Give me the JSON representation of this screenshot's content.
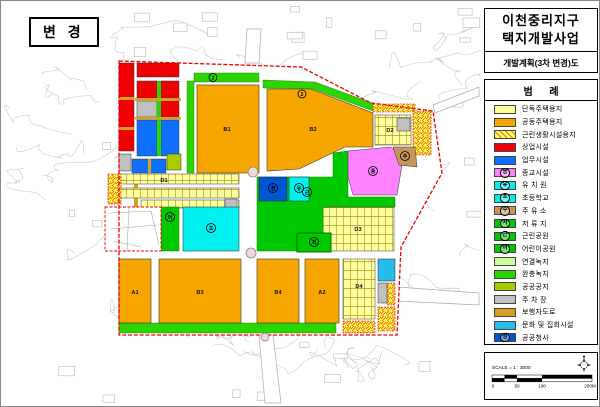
{
  "map": {
    "change_label": "변 경",
    "blocks": {
      "b1": "B1",
      "b2": "B2",
      "b3": "B3",
      "b4": "B4",
      "a1": "A1",
      "a2": "A2",
      "d1": "D1",
      "d2": "D2",
      "d3": "D3",
      "d4": "D4"
    },
    "marks": {
      "buffer1": "2",
      "buffer2": "2",
      "religious": "종",
      "gas": "주",
      "kindergarten": "유",
      "office": "청",
      "park": "근",
      "pond": "저",
      "children": "어",
      "school": "초"
    }
  },
  "panel": {
    "title_line1": "이천중리지구",
    "title_line2": "택지개발사업",
    "subtitle": "개발계획(3차 변경)도",
    "legend_title": "범      례",
    "scale_text": "SCALE = 1 : 3000",
    "scale_ticks": [
      "0",
      "50",
      "100",
      "200M"
    ]
  },
  "legend": {
    "items": [
      {
        "label": "단독주택용지",
        "color": "#FFFF99"
      },
      {
        "label": "공동주택용지",
        "color": "#F7A600"
      },
      {
        "label": "근린생활시설용지",
        "color": "#FFFF66",
        "hatch": true
      },
      {
        "label": "상업시설",
        "color": "#F00000"
      },
      {
        "label": "업무시설",
        "color": "#0F6FFF"
      },
      {
        "label": "종교시설",
        "color": "#FF82FF",
        "mark": "종"
      },
      {
        "label": "유 치 원",
        "color": "#00F0F0",
        "mark": "유"
      },
      {
        "label": "초등학교",
        "color": "#00F0F0",
        "mark": "초"
      },
      {
        "label": "주 유 소",
        "color": "#C8965A",
        "mark": "주"
      },
      {
        "label": "저 류 지",
        "color": "#00C800",
        "mark": "저"
      },
      {
        "label": "근린공원",
        "color": "#00C800",
        "mark": "근"
      },
      {
        "label": "어린이공원",
        "color": "#00C800",
        "mark": "어"
      },
      {
        "label": "연결녹지",
        "color": "#CCFF99"
      },
      {
        "label": "완충녹지",
        "color": "#2BD500"
      },
      {
        "label": "공공공지",
        "color": "#A8CC00"
      },
      {
        "label": "주 차 장",
        "color": "#C0C0C0"
      },
      {
        "label": "보행자도로",
        "color": "#D8A020"
      },
      {
        "label": "문화 및 집회시설",
        "color": "#28BCEC"
      },
      {
        "label": "공공청사",
        "color": "#0055D4",
        "mark": "청"
      }
    ]
  },
  "palette": {
    "single": "#FFFF99",
    "multi": "#F7A600",
    "commercial": "#F00000",
    "business": "#0F6FFF",
    "religious": "#FF82FF",
    "school": "#00F0F0",
    "gas": "#C8965A",
    "park": "#00C800",
    "connGreen": "#CCFF99",
    "buffer": "#2BD500",
    "publicOpen": "#A8CC00",
    "parking": "#C0C0C0",
    "pedestrian": "#D8A020",
    "cultural": "#28BCEC",
    "office": "#0055D4",
    "boundary": "#F00000",
    "hatchLine": "#E07800"
  }
}
